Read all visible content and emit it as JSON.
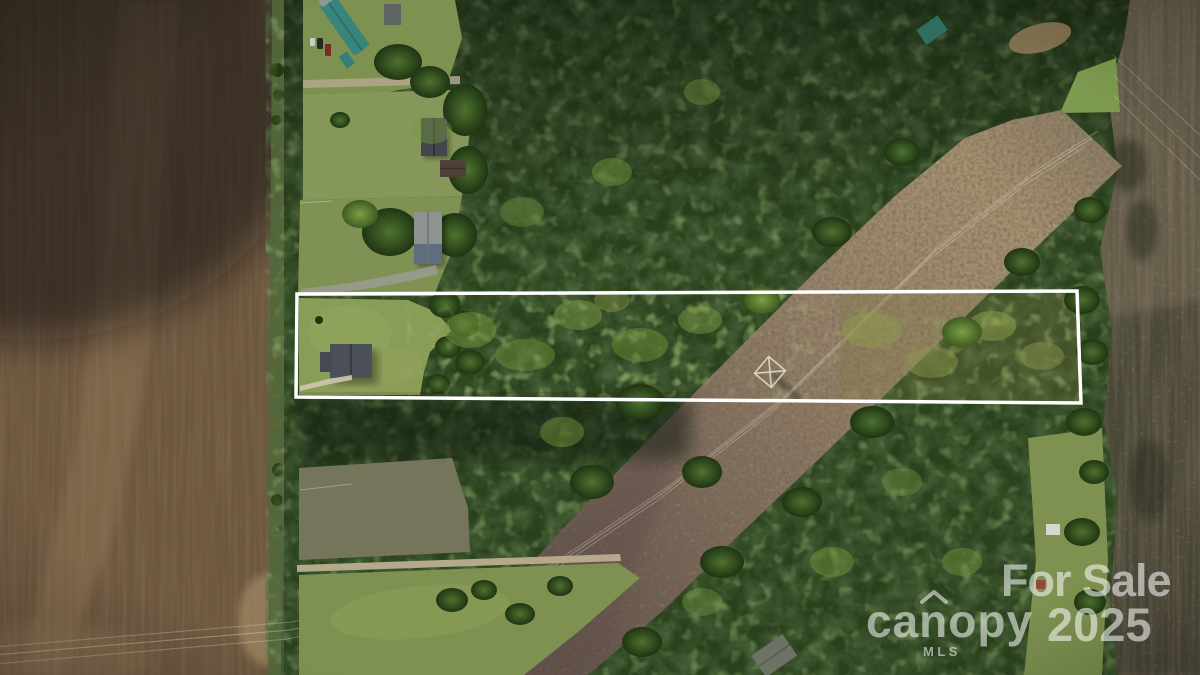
{
  "image": {
    "kind": "aerial-drone-real-estate-photo",
    "description": "Top-down aerial view of a rural two-lane road bordered by plowed farmland on the west and lawns, homes and dense woods on the east; a long narrow wooded parcel outlined in white extends east from the road, crossed near its east end by a cleared power-line corridor; listing watermarks overlay the lower right."
  },
  "watermark": {
    "sale_label": "For Sale",
    "year": "2025",
    "brand": "canopy",
    "brand_sub": "MLS",
    "color": "rgba(255,255,255,0.55)"
  },
  "property_boundary": {
    "color": "#ffffff",
    "stroke_width": 3.5,
    "points": [
      [
        297,
        294
      ],
      [
        1077,
        291
      ],
      [
        1081,
        403
      ],
      [
        296,
        397
      ]
    ]
  },
  "palette": {
    "farmland": "#6e573f",
    "road_mid": "#7c7f79",
    "forest": "#2a411d",
    "lawn": "#85985a",
    "parcel_lawn": "#8a9d58",
    "corridor": "#93806a",
    "pasture": "#7e9150",
    "olive_field": "#74755a",
    "right_field": "#635b49",
    "dirt_road": "#b5a98c"
  }
}
